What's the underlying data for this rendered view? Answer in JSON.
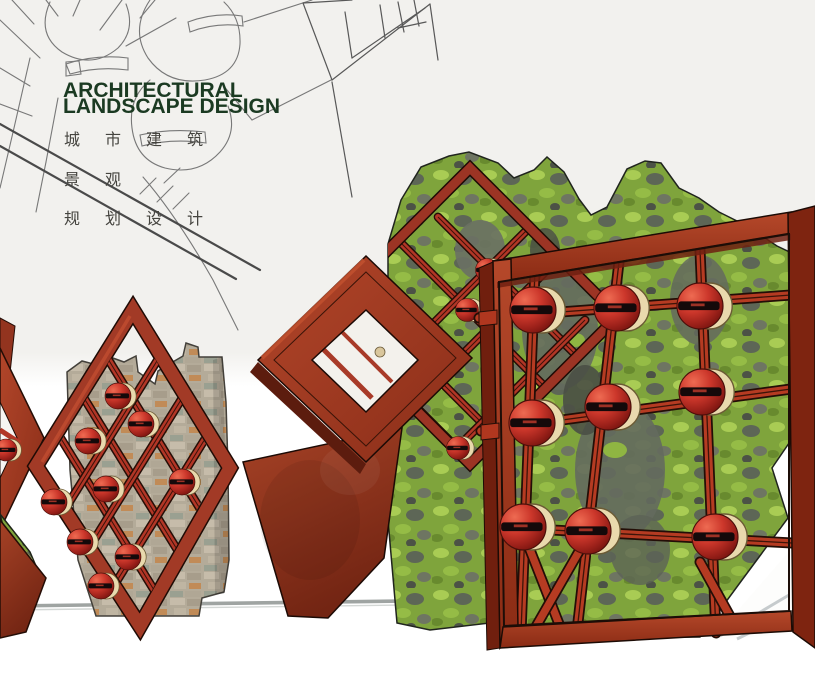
{
  "poster": {
    "title_line1": "ARCHITECTURAL",
    "title_line2": "LANDSCAPE DESIGN",
    "subtitle_cn_line1": "城市建筑",
    "subtitle_cn_line2": "景观",
    "subtitle_cn_line3": "规划设计"
  },
  "palette": {
    "title_green": "#1b3a22",
    "subtitle_gray": "#45443f",
    "corten_red_frame": "#a83a24",
    "bright_red_bar": "#b5382a",
    "sphere_red": "#c6332b",
    "sphere_cradle_cream": "#e9d9ad",
    "sphere_slot_black": "#14090a",
    "moss_green": "#7fa43c",
    "moss_light_green": "#a9cc54",
    "rock_gray": "#646a5e",
    "stone_wall_beige": "#b4ab99",
    "sketch_line_gray": "#777777",
    "road_line_gray": "#4a4a4a",
    "ground_rail_gray": "#9fa4a2",
    "background_top": "#f2f1ee",
    "background_bottom": "#ffffff"
  }
}
